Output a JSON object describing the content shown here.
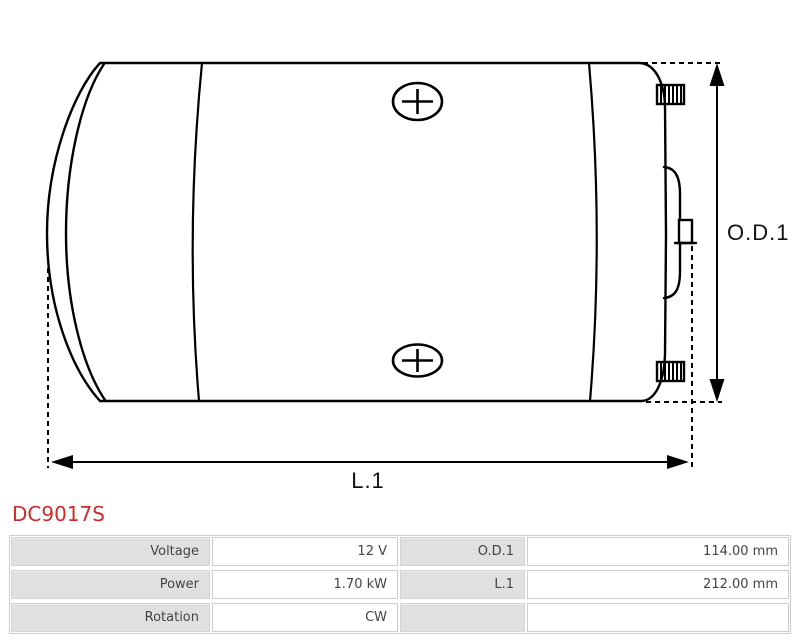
{
  "title": {
    "part_number": "DC9017S"
  },
  "diagram": {
    "description": "side-view technical drawing of DC motor body",
    "dimension_labels": {
      "od1": "O.D.1",
      "l1": "L.1"
    },
    "line_color": "#000000"
  },
  "specs_table": {
    "rows": [
      {
        "label1": "Voltage",
        "value1": "12 V",
        "label2": "O.D.1",
        "value2": "114.00 mm"
      },
      {
        "label1": "Power",
        "value1": "1.70 kW",
        "label2": "L.1",
        "value2": "212.00 mm"
      },
      {
        "label1": "Rotation",
        "value1": "CW",
        "label2": "",
        "value2": ""
      }
    ]
  },
  "colors": {
    "accent_red": "#cc2b2b",
    "label_cell_bg": "#e0e0e0",
    "cell_border": "#cccccc"
  }
}
